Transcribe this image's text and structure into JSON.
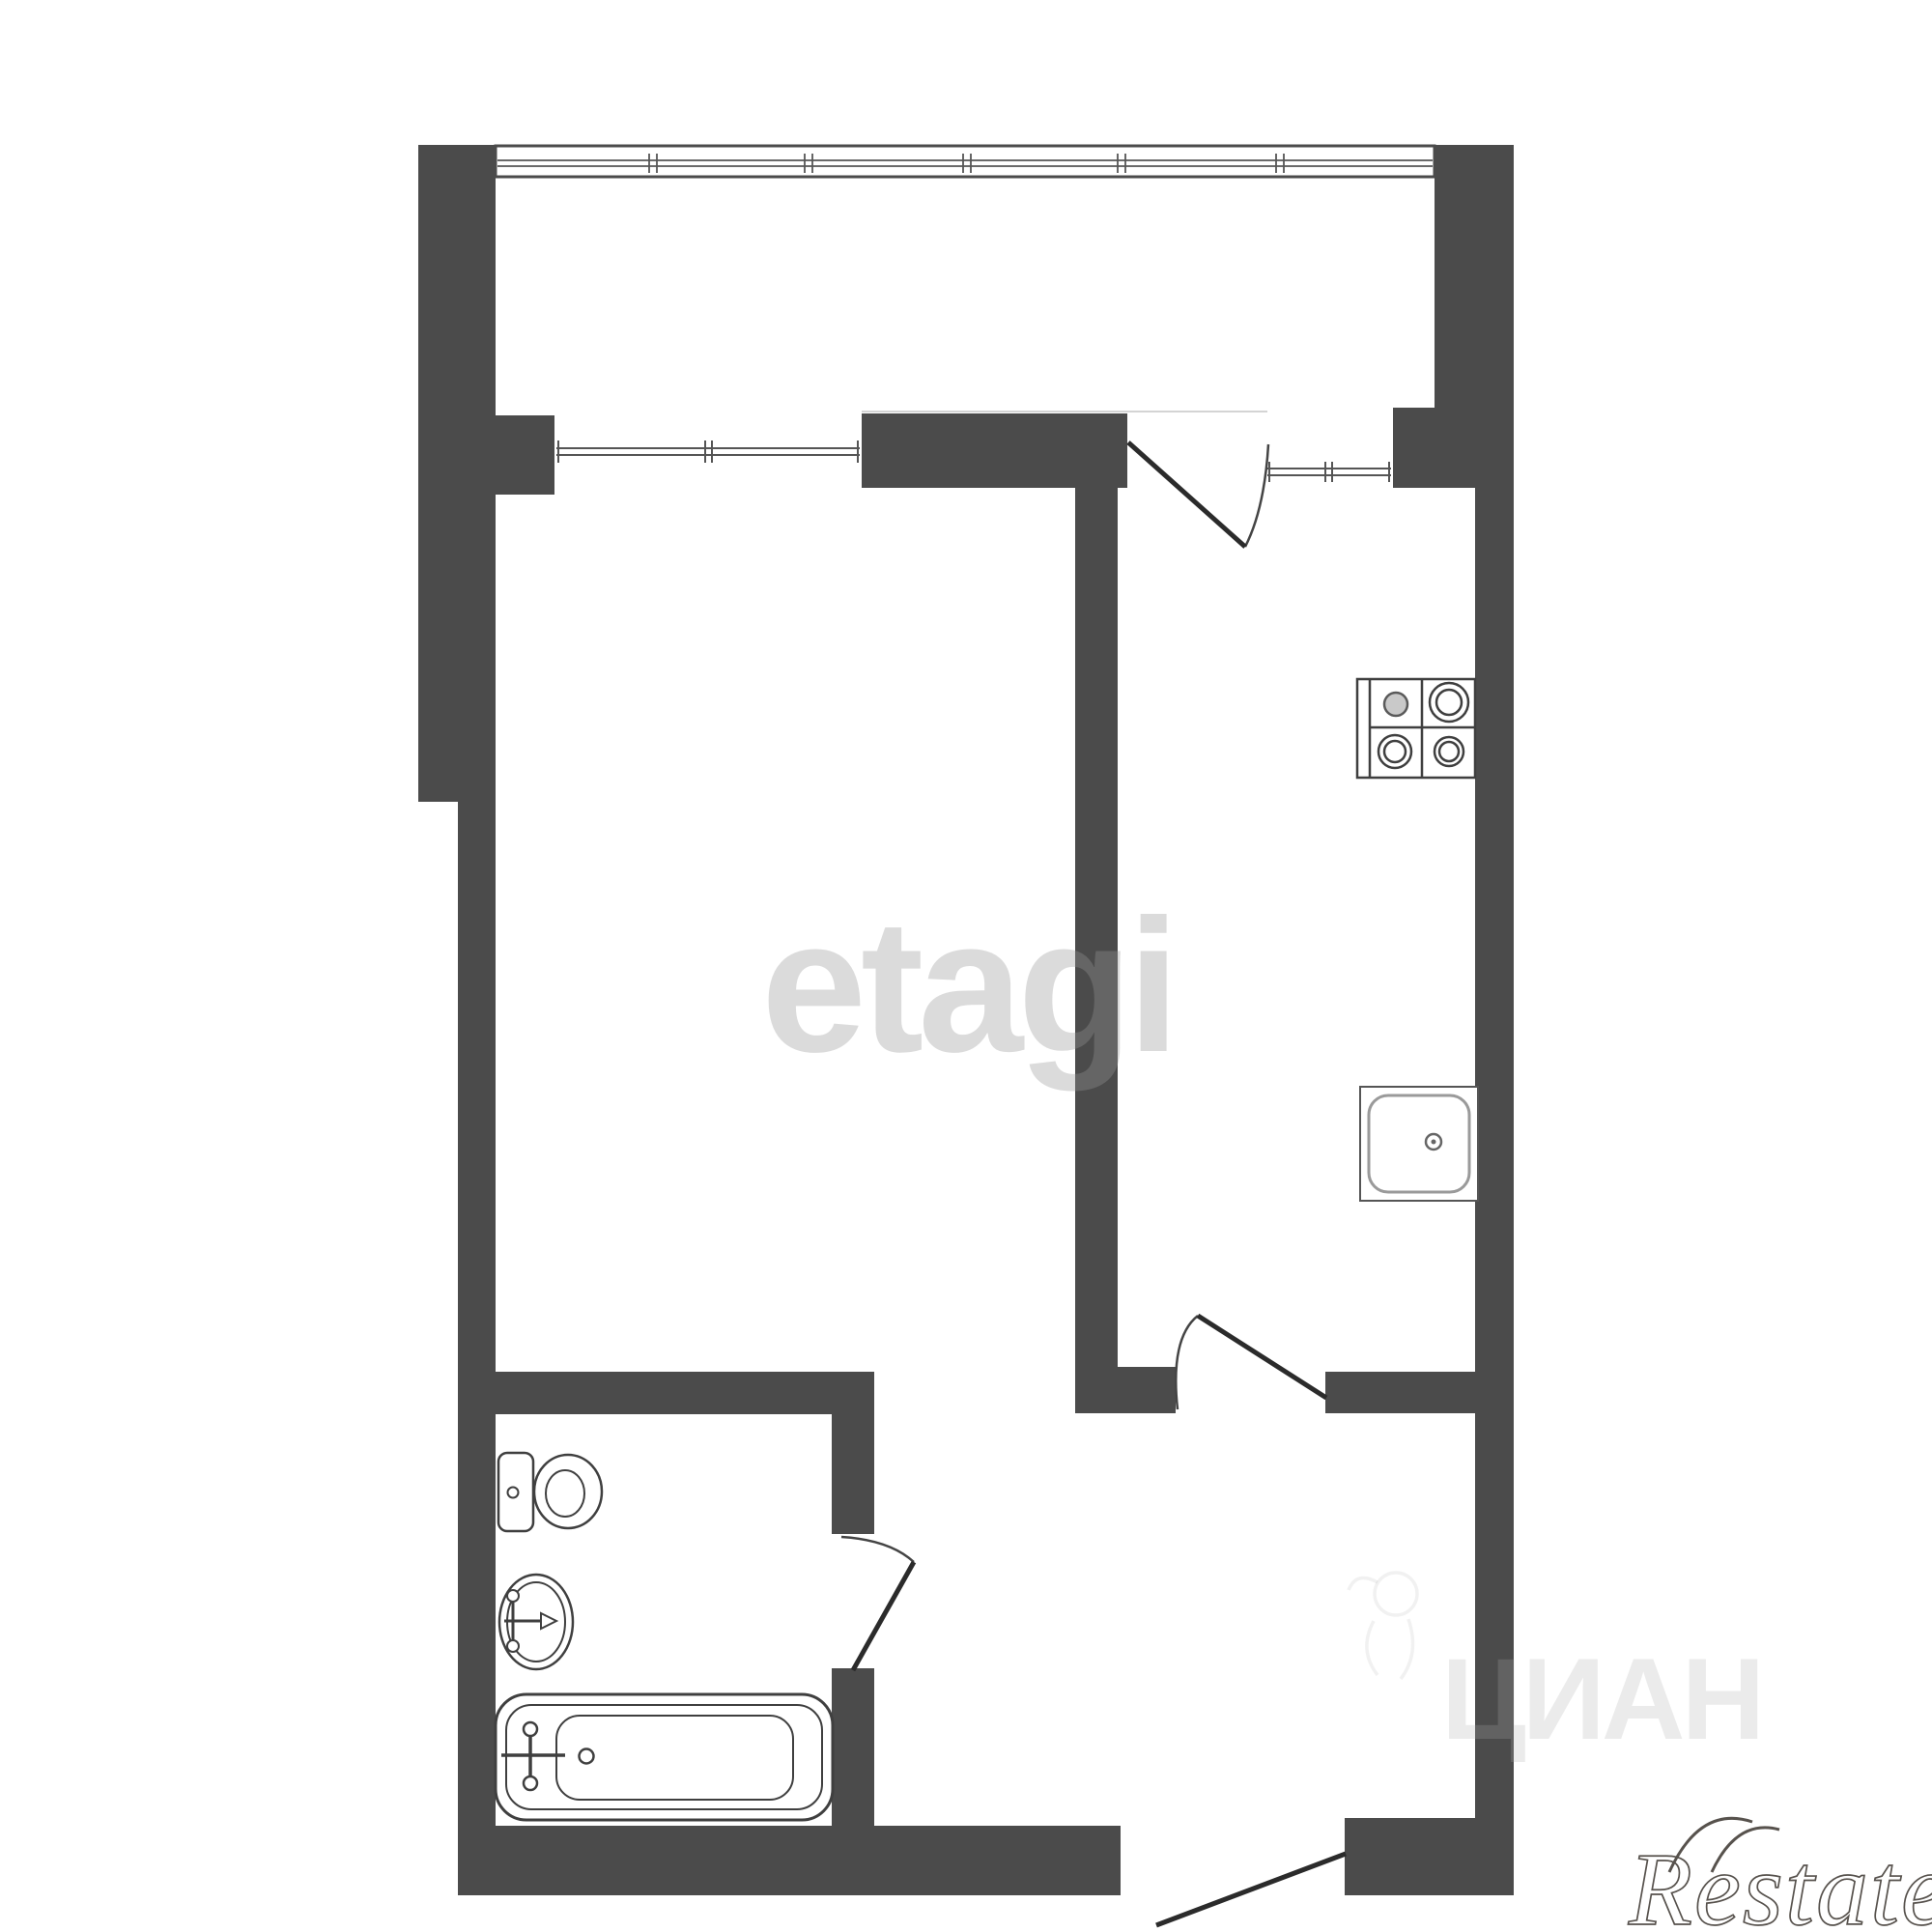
{
  "title": "apartment-floor-plan",
  "watermarks": {
    "center": "etagi",
    "site": "ЦИАН",
    "corner": "Restate"
  },
  "colors": {
    "background": "#ffffff",
    "wall": "#4b4b4b",
    "outline": "#3f3f3f",
    "glazing": "#555555",
    "watermark_center_gray": "#999999",
    "watermark_site_gray": "#aaaaaa",
    "watermark_corner_stroke": "#57524d"
  },
  "fixtures": {
    "kitchen": [
      "stove-4-burner",
      "sink"
    ],
    "bathroom": [
      "toilet",
      "washbasin",
      "bathtub"
    ]
  },
  "openings": {
    "windows": 3,
    "doors": 4
  }
}
